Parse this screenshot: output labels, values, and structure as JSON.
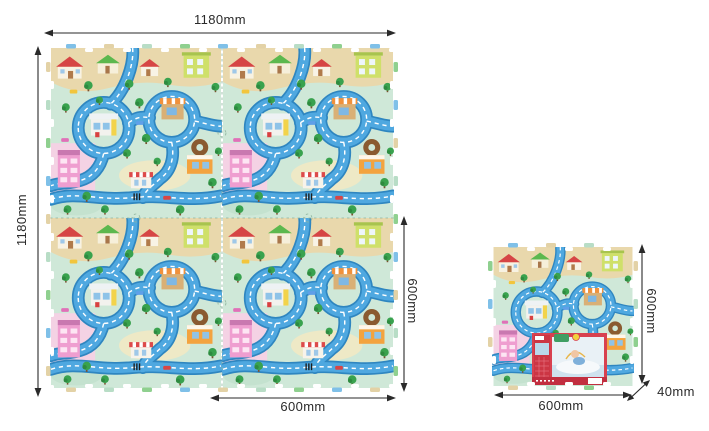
{
  "colors": {
    "background": "#ffffff",
    "dimension_line": "#2a2a2a",
    "mat_base": "#cfe8d8",
    "road": "#4fa8e0",
    "road_edge": "#2f86c0",
    "top_band": "#e9d8ac",
    "packaging_red": "#d8414f"
  },
  "large_mat": {
    "top_dimension": "1180mm",
    "left_dimension": "1180mm",
    "right_dimension": "600mm",
    "bottom_dimension": "600mm"
  },
  "small_tile": {
    "right_dimension": "600mm",
    "bottom_dimension": "600mm",
    "thickness_dimension": "40mm"
  }
}
